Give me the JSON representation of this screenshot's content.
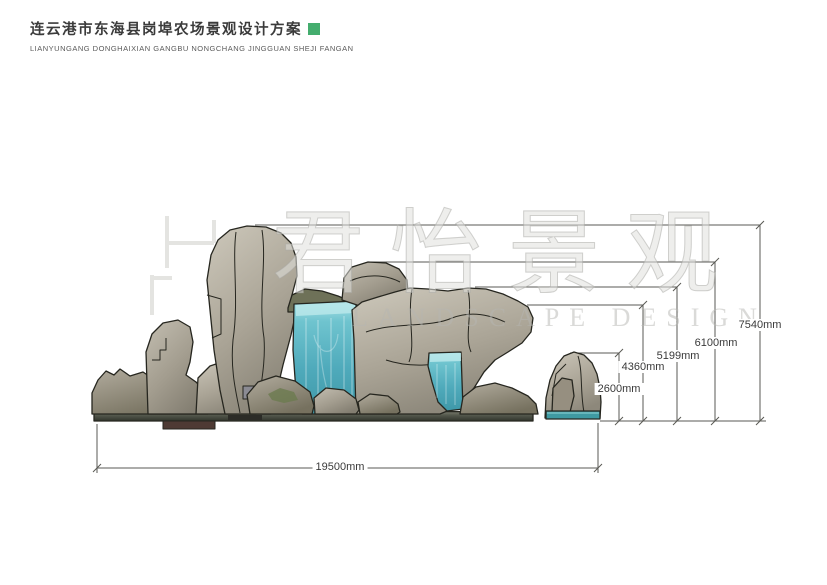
{
  "header": {
    "title": "连云港市东海县岗埠农场景观设计方案",
    "subtitle": "LIANYUNGANG DONGHAIXIAN GANGBU NONGCHANG JINGGUAN SHEJI FANGAN",
    "accent_color": "#44ad6e"
  },
  "watermark": {
    "cn": "君怡景观",
    "en": "LANDSCAPE DESIGN"
  },
  "drawing": {
    "view": "rockery-waterfall-elevation",
    "unit": "mm",
    "height_dimensions": [
      {
        "label": "7540mm",
        "value": 7540
      },
      {
        "label": "6100mm",
        "value": 6100
      },
      {
        "label": "5199mm",
        "value": 5199
      },
      {
        "label": "4360mm",
        "value": 4360
      },
      {
        "label": "2600mm",
        "value": 2600
      }
    ],
    "width_dimension": {
      "label": "19500mm",
      "value": 19500
    },
    "colors": {
      "rock": "#a6a092",
      "rock_dark": "#7d786c",
      "water": "#58b4c2",
      "outline": "#26261f",
      "dimension_line": "#5a5a55"
    }
  }
}
